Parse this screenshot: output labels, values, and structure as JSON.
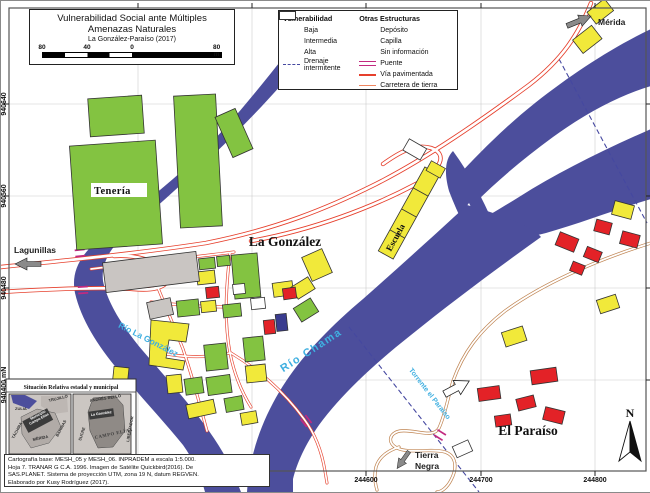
{
  "title": {
    "line1": "Vulnerabilidad Social ante Múltiples",
    "line2": "Amenazas Naturales",
    "line3": "La González-Paraíso (2017)"
  },
  "scalebar": {
    "labels": [
      "80",
      "40",
      "0",
      "80 m"
    ]
  },
  "legend": {
    "vuln_header": "Vulnerabilidad",
    "vuln_items": [
      {
        "label": "Baja",
        "color": "#8CC63F"
      },
      {
        "label": "Intermedia",
        "color": "#F1E93A"
      },
      {
        "label": "Alta",
        "color": "#E32227"
      }
    ],
    "drenaje_line1": "Drenaje",
    "drenaje_line2": "intermitente",
    "otras_header": "Otras Estructuras",
    "otras_items": [
      {
        "label": "Depósito",
        "color": "#C9C5C2"
      },
      {
        "label": "Capilla",
        "color": "#3A3C8F"
      },
      {
        "label": "Sin información",
        "color": "#FFFFFF"
      }
    ],
    "line_items": [
      {
        "label": "Puente",
        "color": "#C22A80"
      },
      {
        "label": "Vía pavimentada",
        "color": "#E6402D"
      },
      {
        "label": "Carretera de tierra",
        "color": "#EF8660"
      }
    ]
  },
  "map_labels": {
    "teneria": "Tenería",
    "la_gonzalez": "La González",
    "el_paraiso": "El Paraíso",
    "escuela": "Escuela",
    "lagunillas": "Lagunillas",
    "merida": "Mérida",
    "tierra_negra_line1": "Tierra",
    "tierra_negra_line2": "Negra",
    "rio_chama": "Río Chama",
    "rio_la_gonzalez": "Río La González",
    "torrente": "Torrente el Paraíso",
    "north": "N"
  },
  "axes": {
    "x": [
      "244400 mE",
      "244500",
      "244600",
      "244700",
      "244800"
    ],
    "y": [
      "940640",
      "940560",
      "940480",
      "940400 mN"
    ]
  },
  "inset": {
    "title": "Situación Relativa estadal y municipal",
    "states": {
      "zulia": "ZULIA",
      "trujillo": "TRUJILLO",
      "tachira": "TÁCHIRA",
      "merida": "MÉRIDA",
      "barinas": "BARINAS",
      "highlight_line1": "Municipio",
      "highlight_line2": "Campo Elías"
    },
    "municipalities": {
      "top": "ANDRÉS BELLO",
      "la_gonzalez": "La González",
      "sucre": "SUCRE",
      "campo_elias": "CAMPO ELÍAS",
      "libertador": "LIBERTADOR"
    }
  },
  "credits": {
    "line1": "Cartografía base: MESH_05 y MESH_06. INPRADEM a escala 1:5.000.",
    "line2": "Hoja 7. TRANAR G C.A. 1996. Imagen de Satélite Quickbird(2016). De",
    "line3": "SAS.PLANET. Sistema de proyección UTM, zona 19 N, datum REGVEN.",
    "line4": "Elaborado por Kusy Rodríguez (2017)."
  },
  "colors": {
    "river": "#4C4E9C",
    "road_paved": "#E6402D",
    "road_dirt": "#BF8350",
    "drainage": "#4548A0",
    "bridge": "#C22A80",
    "water_label": "#3FAFE0"
  }
}
